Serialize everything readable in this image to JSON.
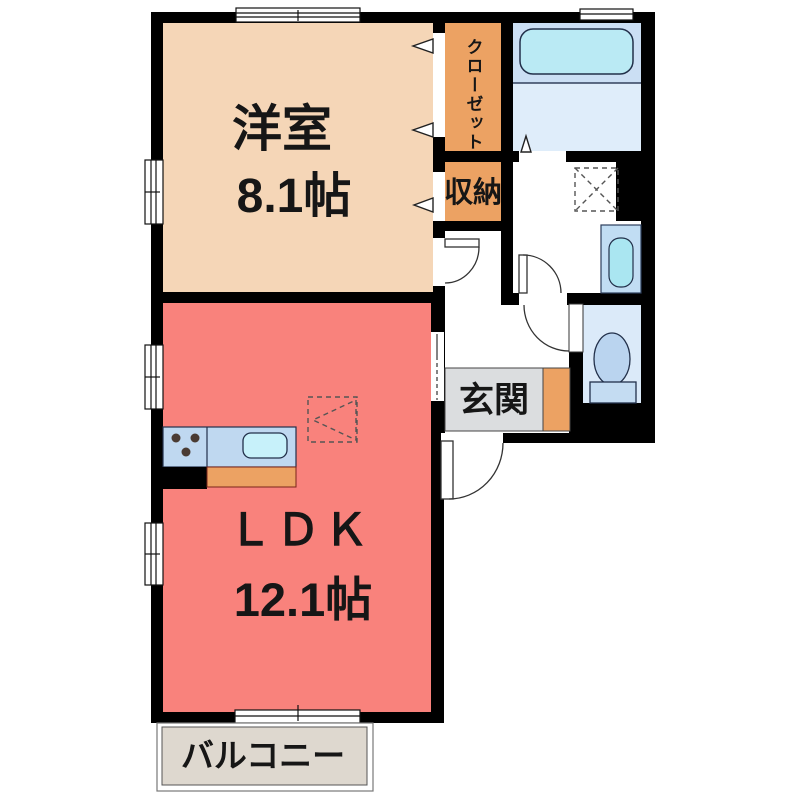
{
  "plan_title": "1LDK floor plan",
  "rooms": {
    "western_room": {
      "label": "洋室",
      "size": "8.1帖"
    },
    "ldk": {
      "label": "ＬＤＫ",
      "size": "12.1帖"
    },
    "closet": {
      "label": "クローゼット"
    },
    "storage": {
      "label": "収納"
    },
    "entrance": {
      "label": "玄関"
    },
    "balcony": {
      "label": "バルコニー"
    }
  },
  "fixtures": {
    "bathtub": "bathtub",
    "washing_machine_space": "washing-machine-space",
    "vanity_sink": "vanity-sink",
    "toilet": "toilet",
    "kitchen_counter": "kitchen-counter",
    "kitchen_sink": "kitchen-sink",
    "stove_burners": "stove-burners",
    "refrigerator_space": "refrigerator-space"
  },
  "colors": {
    "wall": "#000000",
    "western_room": "#F5D6B7",
    "ldk": "#F9827C",
    "orange": "#ECA263",
    "entrance_gray": "#DBDDDF",
    "balcony": "#DED8CF",
    "bath_upper": "#CBDFF4",
    "bath_lower": "#DFEDFA",
    "bathtub": "#BAEAF4",
    "vanity": "#C1DDF3",
    "vanity_basin": "#AAE6F1",
    "toilet_room": "#DBEAF9",
    "toilet_bowl": "#BAD4EF",
    "toilet_tank": "#C4DCF2",
    "counter": "#BFD8F0",
    "kitchen_sink": "#C7F1FA",
    "text": "#161616",
    "line": "#333333"
  }
}
